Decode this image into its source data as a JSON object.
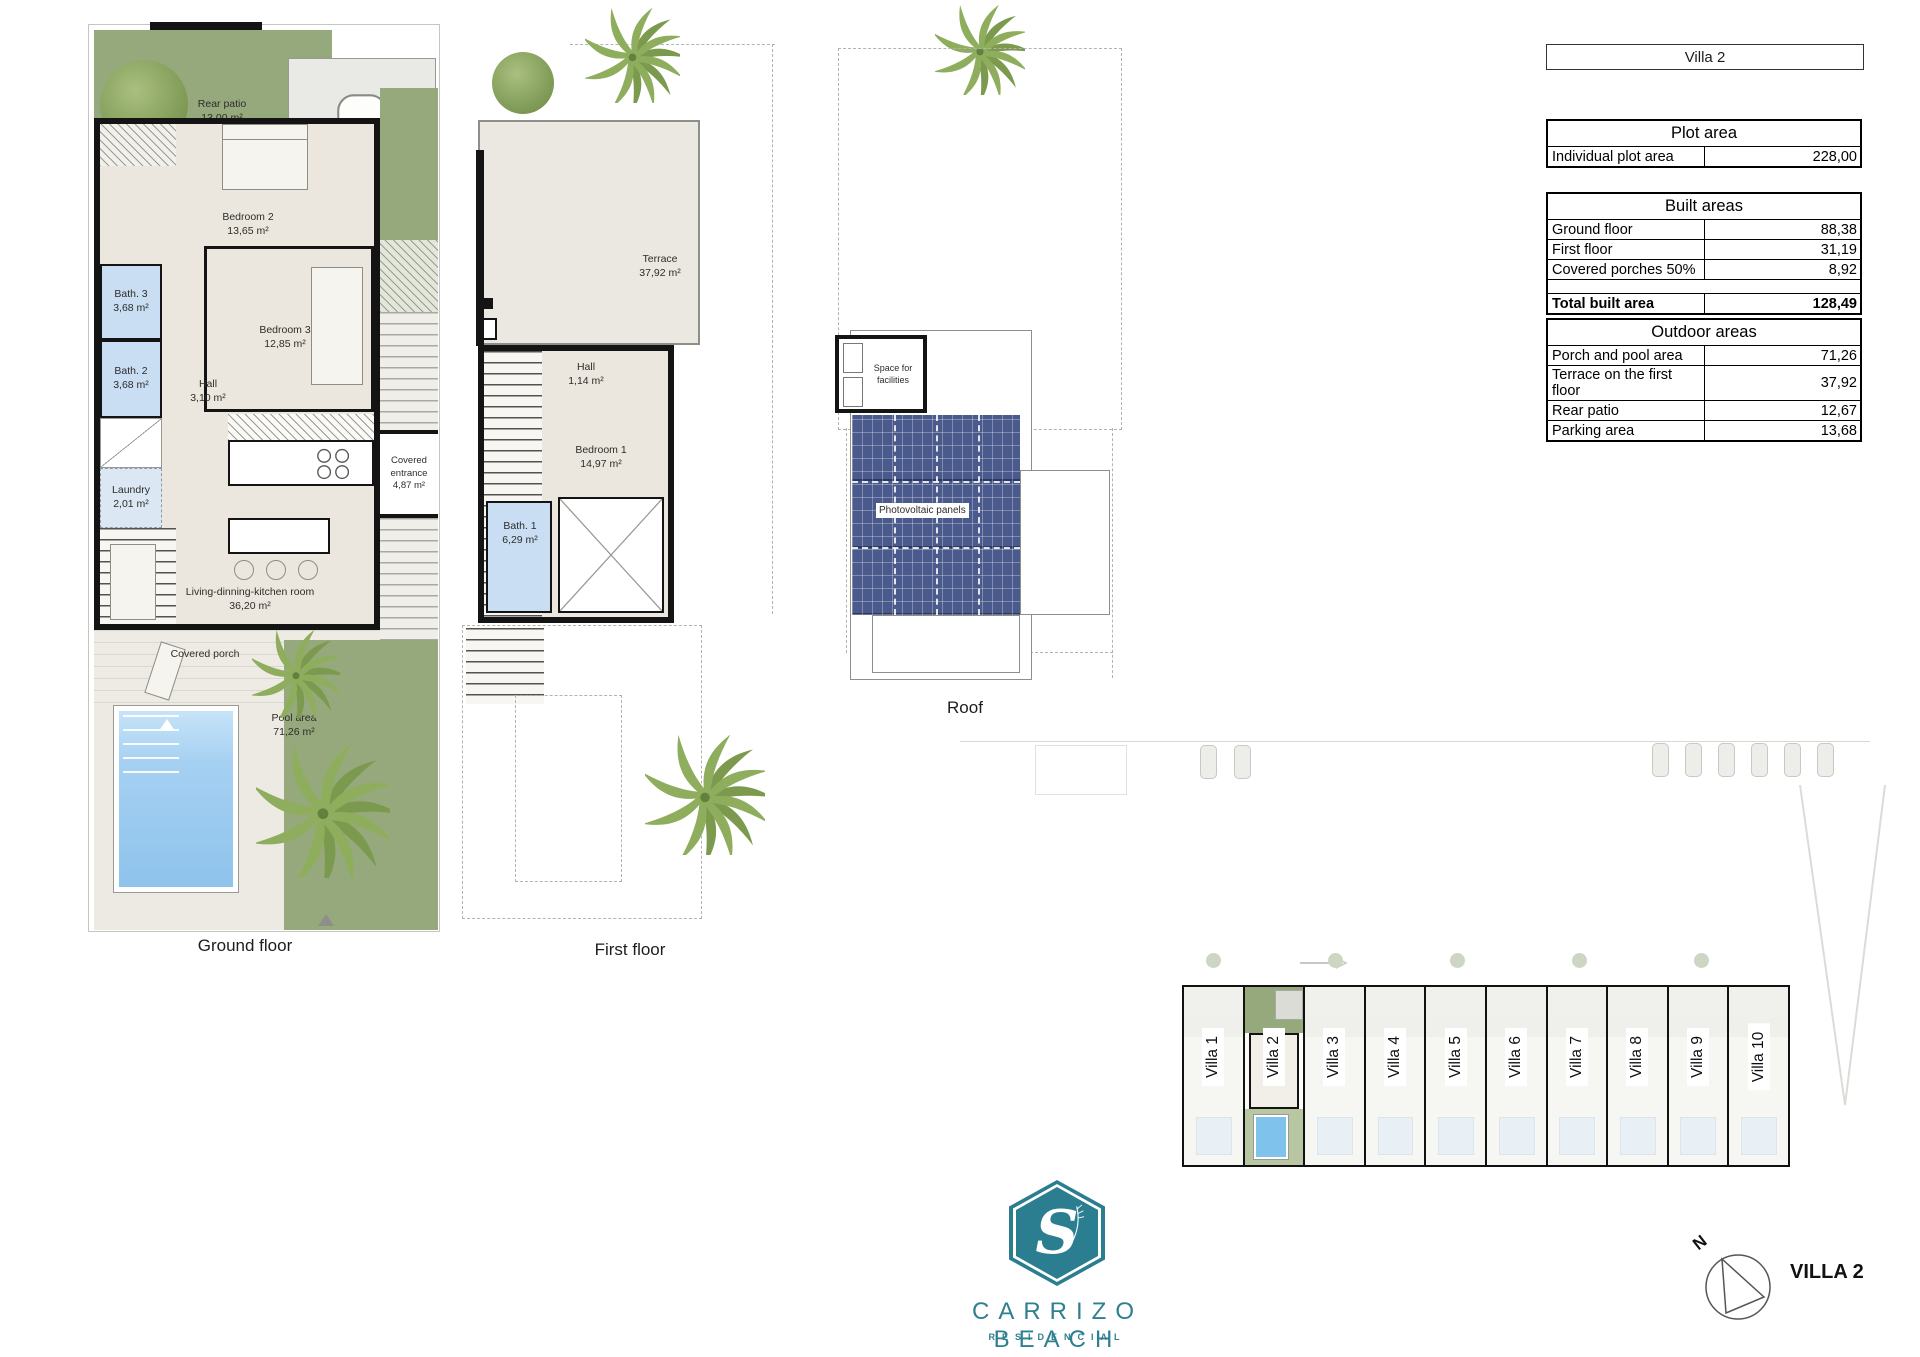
{
  "header": {
    "villa_box": "Villa 2"
  },
  "tables": {
    "plot": {
      "title": "Plot area",
      "rows": [
        {
          "label": "Individual plot area",
          "value": "228,00"
        }
      ]
    },
    "built": {
      "title": "Built areas",
      "rows": [
        {
          "label": "Ground floor",
          "value": "88,38"
        },
        {
          "label": "First floor",
          "value": "31,19"
        },
        {
          "label": "Covered porches 50%",
          "value": "8,92"
        }
      ],
      "total": {
        "label": "Total built area",
        "value": "128,49"
      }
    },
    "outdoor": {
      "title": "Outdoor areas",
      "rows": [
        {
          "label": "Porch and pool area",
          "value": "71,26"
        },
        {
          "label": "Terrace on the first floor",
          "value": "37,92"
        },
        {
          "label": "Rear patio",
          "value": "12,67"
        },
        {
          "label": "Parking area",
          "value": "13,68"
        }
      ]
    }
  },
  "plans": {
    "ground": {
      "caption": "Ground floor",
      "rear_patio": {
        "name": "Rear patio",
        "area": "13,00 m²"
      },
      "bedroom2": {
        "name": "Bedroom 2",
        "area": "13,65 m²"
      },
      "bath3": {
        "name": "Bath. 3",
        "area": "3,68 m²"
      },
      "bath2": {
        "name": "Bath. 2",
        "area": "3,68 m²"
      },
      "hall": {
        "name": "Hall",
        "area": "3,10 m²"
      },
      "bedroom3": {
        "name": "Bedroom 3",
        "area": "12,85 m²"
      },
      "laundry": {
        "name": "Laundry",
        "area": "2,01 m²"
      },
      "living": {
        "name": "Living-dinning-kitchen room",
        "area": "36,20 m²"
      },
      "entrance": {
        "name": "Covered entrance",
        "area": "4,87 m²"
      },
      "porch": {
        "name": "Covered porch"
      },
      "pool": {
        "name": "Pool area",
        "area": "71,26 m²"
      }
    },
    "first": {
      "caption": "First floor",
      "terrace": {
        "name": "Terrace",
        "area": "37,92 m²"
      },
      "hall": {
        "name": "Hall",
        "area": "1,14 m²"
      },
      "bedroom1": {
        "name": "Bedroom 1",
        "area": "14,97 m²"
      },
      "bath1": {
        "name": "Bath. 1",
        "area": "6,29 m²"
      }
    },
    "roof": {
      "caption": "Roof",
      "facilities": "Space for facilities",
      "pv": "Photovoltaic panels"
    }
  },
  "siteplan": {
    "villas": [
      "Villa 1",
      "Villa 2",
      "Villa 3",
      "Villa 4",
      "Villa 5",
      "Villa 6",
      "Villa 7",
      "Villa 8",
      "Villa 9",
      "Villa 10"
    ],
    "highlighted": "Villa 2"
  },
  "branding": {
    "monogram": "S",
    "name": "CARRIZO BEACH",
    "subtitle": "RESIDENCIAL"
  },
  "compass": {
    "north": "N",
    "label": "VILLA 2"
  },
  "colors": {
    "accent_teal": "#2B7E90",
    "garden_green": "#96A97C",
    "bath_blue": "#C9DEF2",
    "pool_blue": "#9ECDF0",
    "pv_blue": "#4A5A8C"
  }
}
